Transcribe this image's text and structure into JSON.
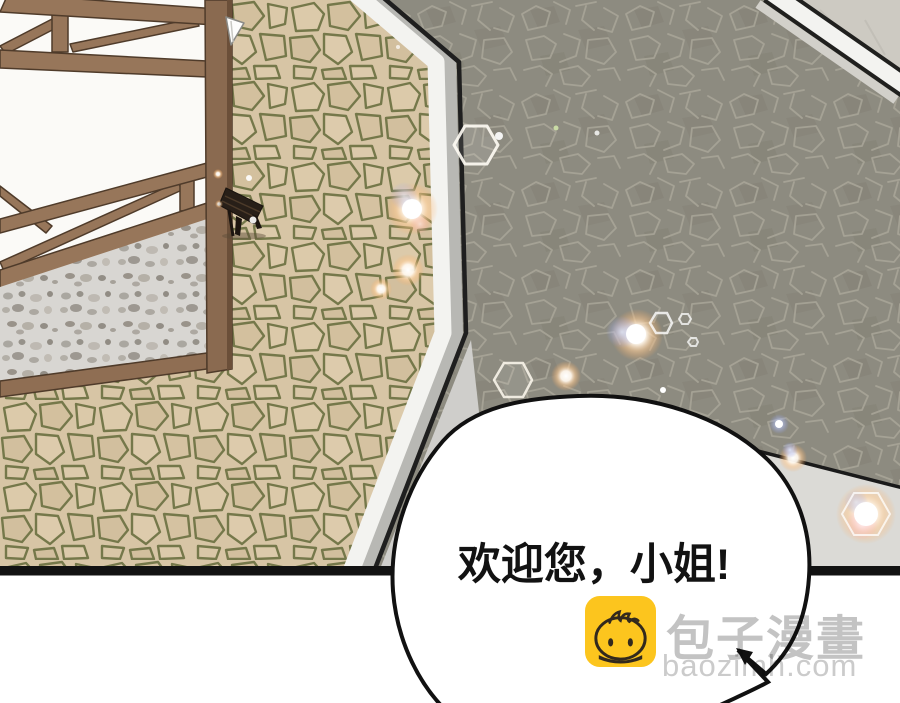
{
  "speech_bubble": {
    "text": "欢迎您，小姐!"
  },
  "watermark": {
    "site_name": "包子漫畫",
    "site_url": "baozimh.com",
    "icon": "baozi-mascot-icon",
    "icon_color": "#fcc51e",
    "text_color": "#c3c3c3"
  },
  "palette": {
    "plaza_cobblestone": "#d7c5a5",
    "cobble_grout_green": "#75784a",
    "road_stone_gray": "#8d8b80",
    "road_crack_light": "#a8a497",
    "upper_pavement_gray": "#cdcac2",
    "curb_white": "#f3f3f0",
    "curb_shadow_gray": "#b8b8b4",
    "sidewalk_gray": "#dbdad6",
    "timber_brown": "#97765a",
    "timber_dark": "#4f3b2a",
    "wall_white": "#fbfaf7",
    "foundation_stone": "#d8d6d2",
    "bench_dark_wood": "#281f18",
    "panel_border_black": "#121212",
    "bubble_fill": "#ffffff",
    "bubble_outline": "#111111",
    "sparkle_warm": "#ffb46e",
    "sparkle_cool": "#9fb4ff"
  }
}
